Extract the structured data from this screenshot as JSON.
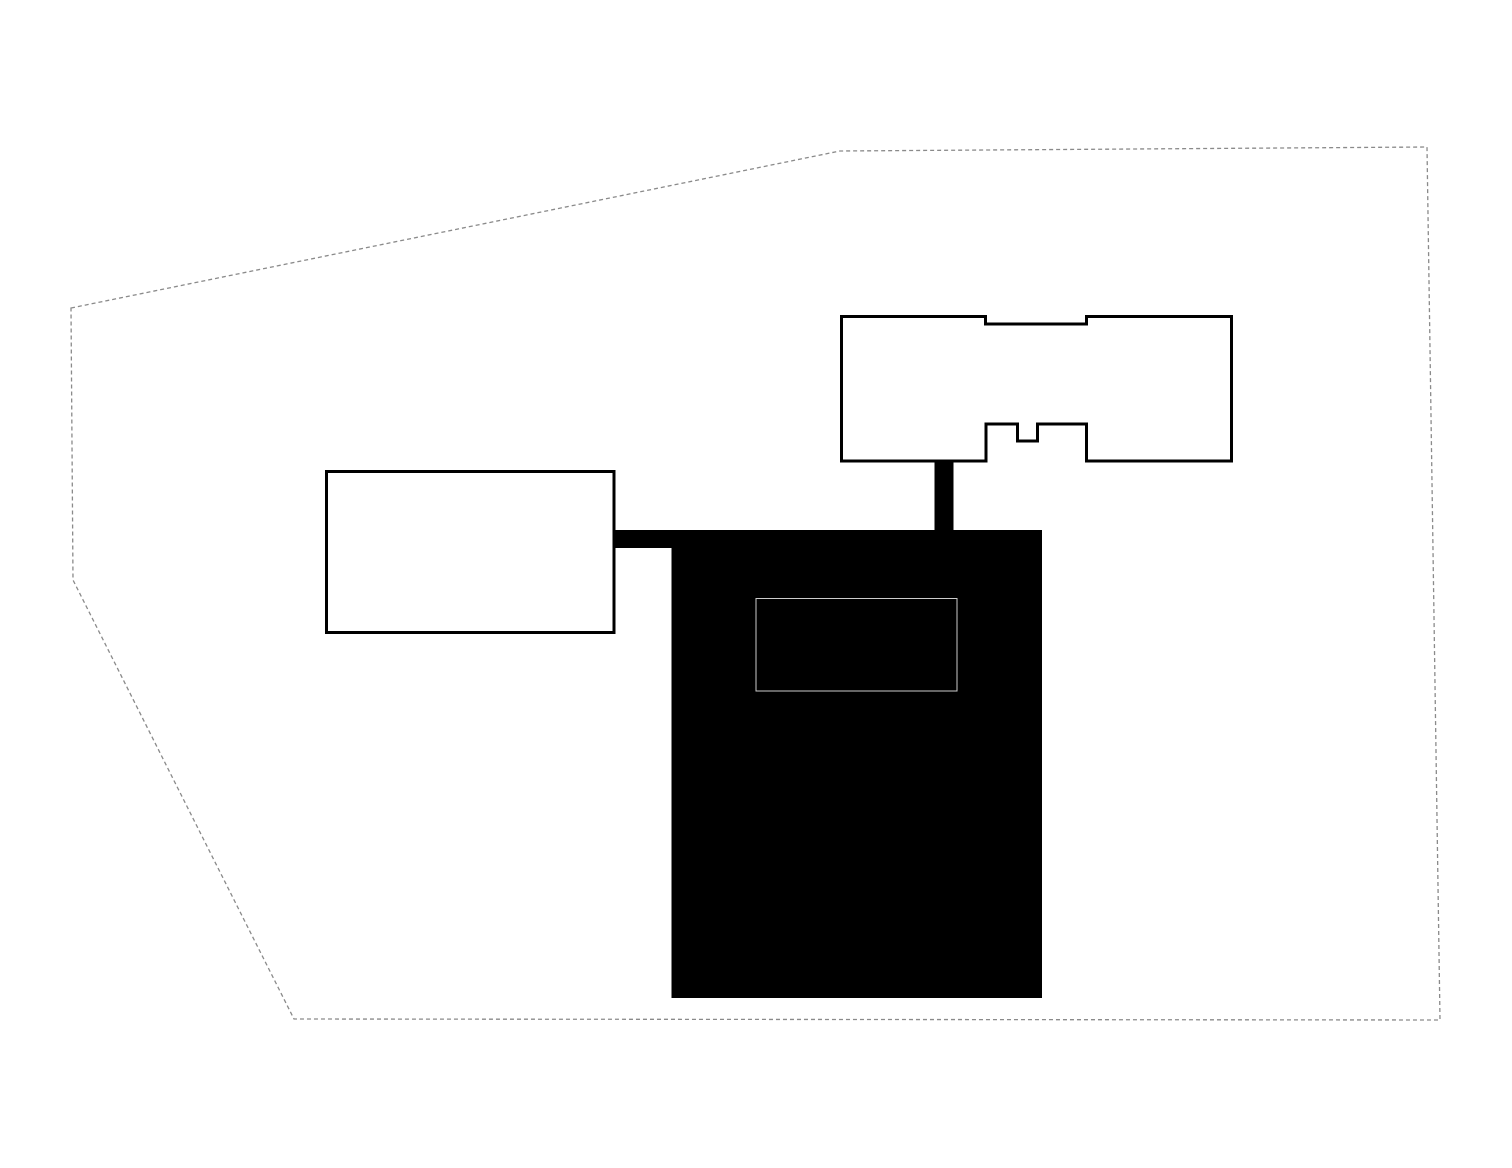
{
  "diagram": {
    "kind": "architectural-site-plan",
    "background_color": "#ffffff",
    "building_line_color": "#000000",
    "building_fill_color": "#ffffff",
    "mass_fill_color": "#000000",
    "boundary_line_color": "#8a8a8a",
    "roof_opening_line_color": "#cccccc",
    "site_boundary": {
      "name": "site-boundary",
      "type": "polygon",
      "points": "71,308 840,151 1427,147 1440,1020 294,1019 73,580",
      "fill": "none",
      "stroke": "#8a8a8a",
      "stroke_width": 1.3,
      "dash": "4 3"
    },
    "shapes": [
      {
        "name": "west-connector-bar",
        "type": "rect",
        "x": 612,
        "y": 530,
        "w": 61,
        "h": 18,
        "fill": "#000000"
      },
      {
        "name": "north-connector-bar",
        "type": "rect",
        "x": 934.5,
        "y": 460,
        "w": 19,
        "h": 71,
        "fill": "#000000"
      },
      {
        "name": "main-building-mass",
        "type": "rect",
        "x": 671.5,
        "y": 530,
        "w": 370.5,
        "h": 468,
        "fill": "#000000"
      },
      {
        "name": "west-building-footprint",
        "type": "rect",
        "x": 326.5,
        "y": 471.5,
        "w": 287.5,
        "h": 161,
        "fill": "#ffffff",
        "stroke": "#000000",
        "stroke_width": 3
      },
      {
        "name": "north-building-footprint",
        "type": "polygon",
        "points": "841.5,316.5 985.5,316.5 985.5,324 1086.5,324 1086.5,316.5 1231.5,316.5 1231.5,461 1086.5,461 1086.5,424 1037.5,424 1037.5,441 1017.5,441 1017.5,424 986,424 986,461 841.5,461",
        "fill": "#ffffff",
        "stroke": "#000000",
        "stroke_width": 3
      },
      {
        "name": "roof-opening-outline",
        "type": "rect",
        "x": 756,
        "y": 598.5,
        "w": 201,
        "h": 92.5,
        "fill": "none",
        "stroke": "#cccccc",
        "stroke_width": 1
      }
    ]
  }
}
